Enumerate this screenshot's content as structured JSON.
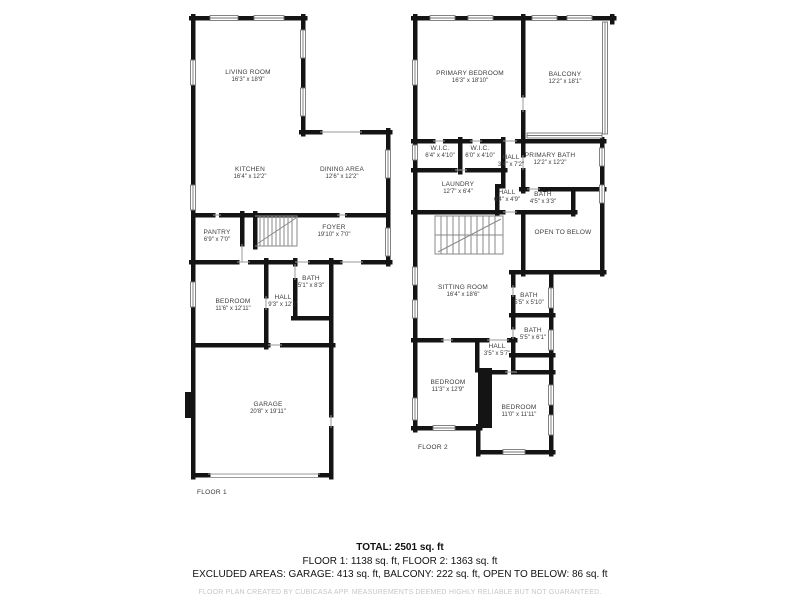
{
  "floor1": {
    "label": "FLOOR 1",
    "rooms": {
      "living": {
        "name": "LIVING ROOM",
        "dims": "16'3\" x 18'9\""
      },
      "kitchen": {
        "name": "KITCHEN",
        "dims": "16'4\" x 12'2\""
      },
      "dining": {
        "name": "DINING AREA",
        "dims": "12'6\" x 12'2\""
      },
      "pantry": {
        "name": "PANTRY",
        "dims": "6'9\" x 7'0\""
      },
      "foyer": {
        "name": "FOYER",
        "dims": "19'10\" x 7'0\""
      },
      "bath": {
        "name": "BATH",
        "dims": "5'1\" x 8'3\""
      },
      "bedroom": {
        "name": "BEDROOM",
        "dims": "11'6\" x 12'11\""
      },
      "hall": {
        "name": "HALL",
        "dims": "9'3\" x 12'1\""
      },
      "garage": {
        "name": "GARAGE",
        "dims": "20'8\" x 19'11\""
      }
    }
  },
  "floor2": {
    "label": "FLOOR 2",
    "rooms": {
      "primary_bedroom": {
        "name": "PRIMARY BEDROOM",
        "dims": "16'3\" x 18'10\""
      },
      "balcony": {
        "name": "BALCONY",
        "dims": "12'2\" x 18'1\""
      },
      "wic1": {
        "name": "W.I.C.",
        "dims": "6'4\" x 4'10\""
      },
      "wic2": {
        "name": "W.I.C.",
        "dims": "6'0\" x 4'10\""
      },
      "hall1": {
        "name": "HALL",
        "dims": "3'4\" x 7'2\""
      },
      "primary_bath": {
        "name": "PRIMARY BATH",
        "dims": "12'2\" x 12'2\""
      },
      "laundry": {
        "name": "LAUNDRY",
        "dims": "12'7\" x 6'4\""
      },
      "hall2": {
        "name": "HALL",
        "dims": "6'4\" x 4'9\""
      },
      "bath1": {
        "name": "BATH",
        "dims": "4'5\" x 3'3\""
      },
      "open_below": {
        "name": "OPEN TO BELOW",
        "dims": ""
      },
      "sitting": {
        "name": "SITTING ROOM",
        "dims": "16'4\" x 18'6\""
      },
      "bath2": {
        "name": "BATH",
        "dims": "5'5\" x 5'10\""
      },
      "bath3": {
        "name": "BATH",
        "dims": "5'5\" x 6'1\""
      },
      "hall3": {
        "name": "HALL",
        "dims": "3'5\" x 5'7\""
      },
      "bedroom1": {
        "name": "BEDROOM",
        "dims": "11'3\" x 12'9\""
      },
      "bedroom2": {
        "name": "BEDROOM",
        "dims": "11'0\" x 11'11\""
      }
    }
  },
  "summary": {
    "total": "TOTAL: 2501 sq. ft",
    "floors": "FLOOR 1: 1138 sq. ft, FLOOR 2: 1363 sq. ft",
    "excluded": "EXCLUDED AREAS: GARAGE: 413 sq. ft, BALCONY: 222 sq. ft, OPEN TO BELOW: 86 sq. ft",
    "disclaimer": "FLOOR PLAN CREATED BY CUBICASA APP. MEASUREMENTS DEEMED HIGHLY RELIABLE BUT NOT GUARANTEED."
  }
}
